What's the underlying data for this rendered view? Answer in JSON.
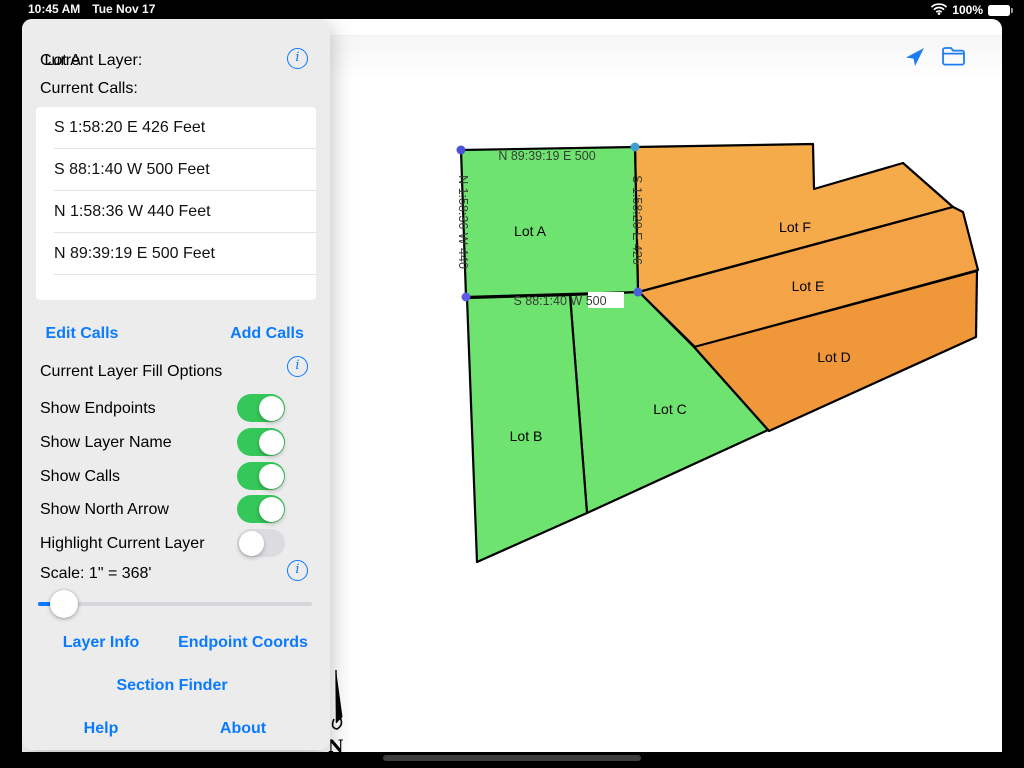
{
  "status_bar": {
    "time": "10:45 AM",
    "date": "Tue Nov 17",
    "battery_pct": "100%"
  },
  "colors": {
    "accent_blue": "#0a7aff",
    "toggle_on_green": "#34c759",
    "lot_green": "#6FE36F",
    "lot_orange_f": "#F6AB4B",
    "lot_orange_e": "#F4A446",
    "lot_orange_d": "#F0973A"
  },
  "sidebar": {
    "current_layer_label": "Current Layer:",
    "current_layer_value": "Lot A",
    "current_calls_label": "Current Calls:",
    "calls": [
      "S 1:58:20 E 426 Feet",
      "S 88:1:40 W 500 Feet",
      "N 1:58:36 W 440 Feet",
      "N 89:39:19 E 500 Feet"
    ],
    "edit_calls_label": "Edit Calls",
    "add_calls_label": "Add Calls",
    "fill_options_label": "Current Layer Fill Options",
    "toggles": [
      {
        "label": "Show Endpoints",
        "on": true
      },
      {
        "label": "Show Layer Name",
        "on": true
      },
      {
        "label": "Show Calls",
        "on": true
      },
      {
        "label": "Show North Arrow",
        "on": true
      },
      {
        "label": "Highlight Current Layer",
        "on": false
      }
    ],
    "scale_label": "Scale: 1\" = 368'",
    "layer_info_label": "Layer Info",
    "endpoint_coords_label": "Endpoint Coords",
    "section_finder_label": "Section Finder",
    "help_label": "Help",
    "about_label": "About"
  },
  "map": {
    "north_label": "N",
    "lots": [
      {
        "name": "Lot F",
        "label": "Lot F",
        "fill": "#F6AB4B",
        "points": "635,147 813,144 814,189 903,163 953,207 638,292",
        "lx": 795,
        "ly": 232
      },
      {
        "name": "Lot E",
        "label": "Lot E",
        "fill": "#F4A446",
        "points": "639,292 953,207 963,212 978,270 695,347",
        "lx": 808,
        "ly": 291
      },
      {
        "name": "Lot D",
        "label": "Lot D",
        "fill": "#F0973A",
        "points": "694,347 977,271 976,337 769,431",
        "lx": 834,
        "ly": 362
      },
      {
        "name": "Lot C",
        "label": "Lot C",
        "fill": "#6FE36F",
        "points": "570,295 639,292 694,347 768,430 587,513",
        "lx": 670,
        "ly": 414
      },
      {
        "name": "Lot B",
        "label": "Lot B",
        "fill": "#6FE36F",
        "points": "467,298 570,295 587,513 477,562",
        "lx": 526,
        "ly": 441
      },
      {
        "name": "Lot A",
        "label": "Lot A",
        "fill": "#6FE36F",
        "points": "461,150 635,147 638,292 466,297",
        "lx": 530,
        "ly": 236
      }
    ],
    "call_labels": [
      {
        "text": "N 89:39:19 E 500",
        "x": 547,
        "y": 160,
        "rotate": 0
      },
      {
        "text": "N 1:58:36 W 440",
        "x": 459,
        "y": 222,
        "rotate": 90
      },
      {
        "text": "S 1:58:20 E 426",
        "x": 633,
        "y": 220,
        "rotate": 90
      },
      {
        "text": "S 88:1:40 W 500",
        "x": 560,
        "y": 305,
        "rotate": 0,
        "bg": {
          "x": 588,
          "y": 292,
          "w": 36,
          "h": 16
        }
      }
    ],
    "endpoints": [
      {
        "x": 461,
        "y": 150,
        "c": "#4a52d8"
      },
      {
        "x": 635,
        "y": 147,
        "c": "#3f9fd0"
      },
      {
        "x": 466,
        "y": 297,
        "c": "#5e5ce6"
      },
      {
        "x": 638,
        "y": 292,
        "c": "#4a62d8"
      }
    ]
  }
}
